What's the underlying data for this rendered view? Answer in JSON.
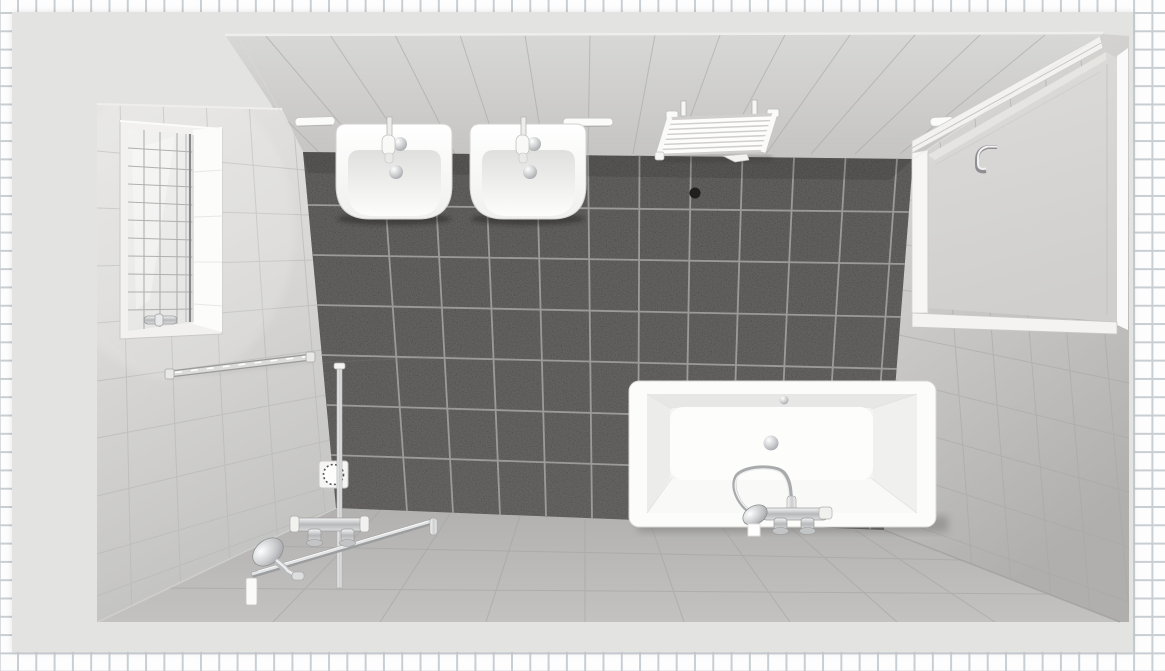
{
  "app": {
    "name": "bathroom-planner-3d-preview",
    "view": "room-render-top-view"
  },
  "scene": {
    "room_type": "bathroom",
    "objects": {
      "window": "casement window with pane grid",
      "towel_bar": "wall towel bar",
      "washbasin_left": "wall-hung washbasin with mixer tap",
      "washbasin_right": "wall-hung washbasin with mixer tap",
      "towel_radiator": "white ladder towel radiator",
      "ceiling_light_left": "recessed light",
      "ceiling_light_center": "recessed light",
      "ceiling_light_right": "recessed light",
      "wall_vent": "round vent hole",
      "floor_drain": "square shower floor drain",
      "shower_set": "thermostatic shower set with slide rail and hand shower",
      "bathtub": "rectangular bathtub",
      "bath_mixer": "bath mixer with hand shower",
      "door": "room door with handle"
    },
    "fixture_counts": {
      "washbasins": 2,
      "bathtubs": 1,
      "shower_sets": 1,
      "towel_radiators": 1,
      "doors": 1,
      "windows": 1,
      "floor_drains": 1
    },
    "materials": {
      "border_tile_color": "#fdfdfe",
      "border_grout_color": "#c8ced2",
      "mat_color": "#e3e3e2",
      "wall_tile_light": "#d9d8d6",
      "floor_tile_dark": "#393837",
      "floor_grout": "#a6a6a4",
      "fixture_white": "#fbfbfa",
      "chrome": "#c6c8ca"
    }
  }
}
